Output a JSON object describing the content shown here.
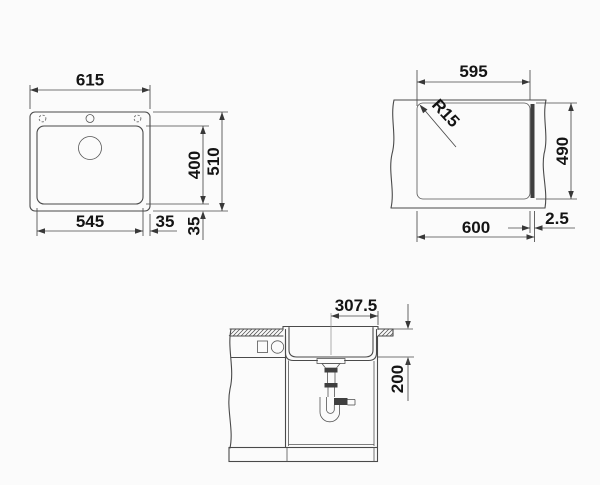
{
  "drawing": {
    "title": "sink-installation-drawing",
    "colors": {
      "line": "#4a4a4a",
      "text": "#141414",
      "background": "#fbfbfb",
      "fitting": "#3f3f3f"
    },
    "top_view": {
      "overall_width": "615",
      "overall_depth": "510",
      "bowl_width": "545",
      "bowl_depth": "400",
      "right_margin": "35",
      "bottom_margin": "35"
    },
    "cutout_view": {
      "cutout_width": "595",
      "cutout_depth": "490",
      "corner_radius": "R15",
      "outer_width": "600",
      "edge_reveal": "2.5"
    },
    "section_view": {
      "drain_offset": "307.5",
      "bowl_depth": "200"
    }
  }
}
